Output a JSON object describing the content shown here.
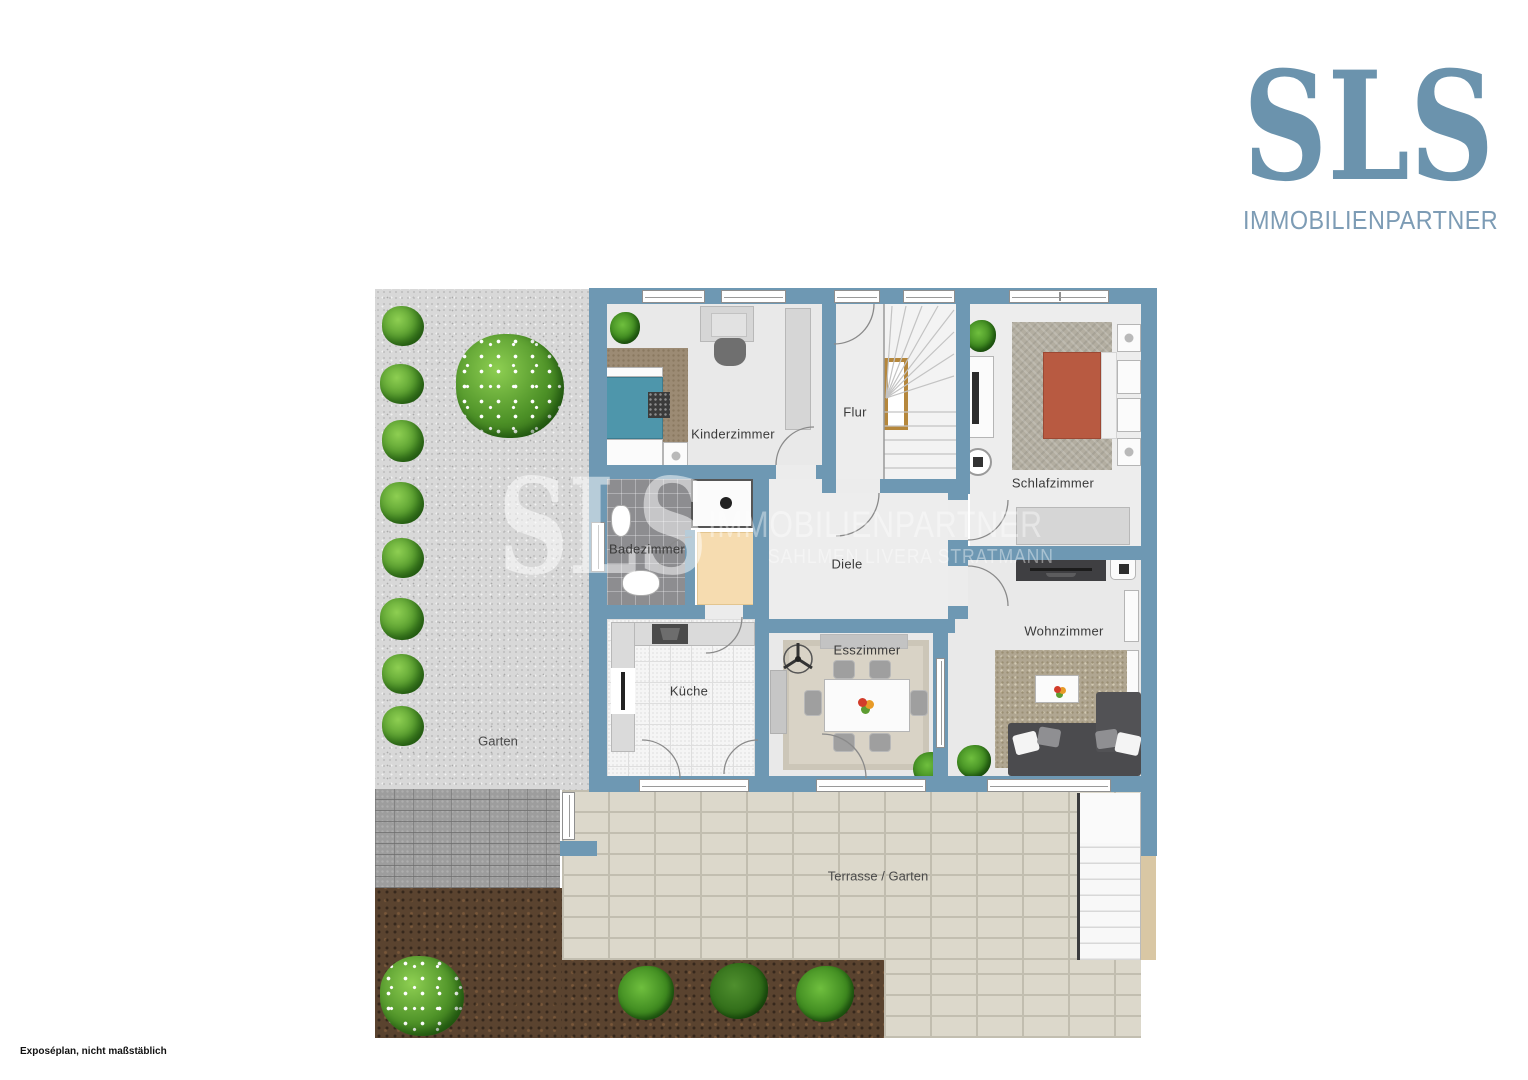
{
  "logo": {
    "title": "SLS",
    "subtitle": "IMMOBILIENPARTNER"
  },
  "watermark": {
    "monogram": "SLS",
    "line1": "IMMOBILIENPARTNER",
    "line2": "SAHLMEN LIVERA STRATMANN"
  },
  "rooms": {
    "kinderzimmer": "Kinderzimmer",
    "flur": "Flur",
    "schlafzimmer": "Schlafzimmer",
    "badezimmer": "Badezimmer",
    "diele": "Diele",
    "wohnzimmer": "Wohnzimmer",
    "kueche": "Küche",
    "esszimmer": "Esszimmer"
  },
  "outdoor": {
    "garten": "Garten",
    "terrasse": "Terrasse / Garten"
  },
  "footer": {
    "note": "Exposéplan, nicht maßstäblich"
  },
  "colors": {
    "wall": "#6e98b3",
    "logo_blue": "#6b93ad",
    "terrace": "#dcd8cb",
    "gravel": "#d8d8d8",
    "soil": "#5a432f",
    "bed_double": "#b85a41",
    "bed_single": "#4e96ab",
    "wardrobe_beige": "#f6dcb0"
  }
}
